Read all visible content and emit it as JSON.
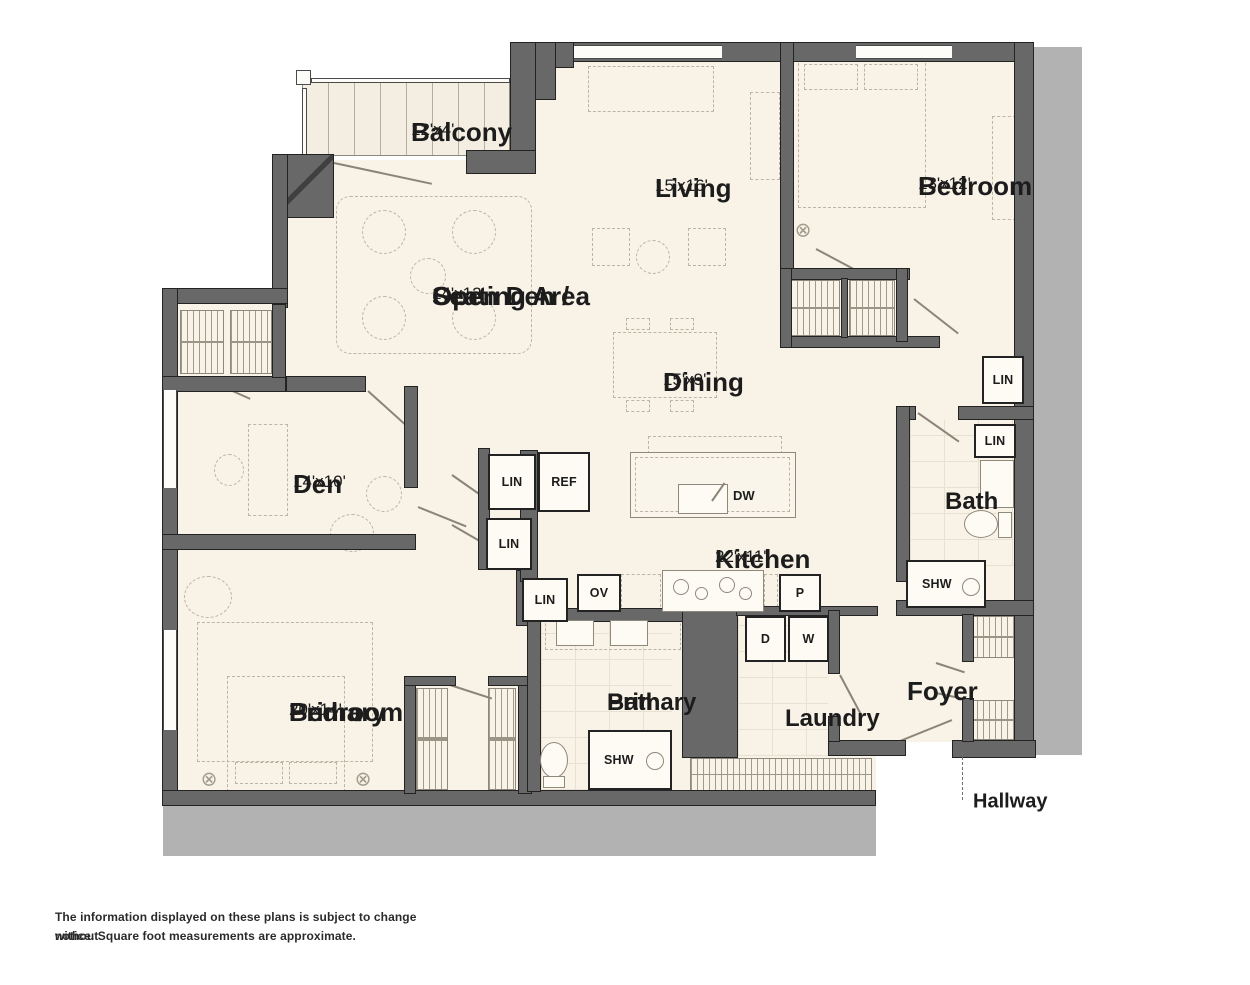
{
  "rooms": {
    "balcony": {
      "name": "Balcony",
      "dims": "12'x4'"
    },
    "living": {
      "name": "Living",
      "dims": "15'x16'"
    },
    "bedroom": {
      "name": "Bedroom",
      "dims": "13'x12'"
    },
    "open_den": {
      "name_line1": "Open Den /",
      "name_line2": "Seating Area",
      "dims": "14'x12'"
    },
    "dining": {
      "name": "Dining",
      "dims": "15'x9'"
    },
    "den": {
      "name": "Den",
      "dims": "14'x10'"
    },
    "kitchen": {
      "name": "Kitchen",
      "dims": "22'x11'"
    },
    "bath": {
      "name": "Bath"
    },
    "primary_bedroom": {
      "name_line1": "Primary",
      "name_line2": "Bedroom",
      "dims": "20'x14'"
    },
    "primary_bath": {
      "name_line1": "Primary",
      "name_line2": "Bath"
    },
    "laundry": {
      "name": "Laundry"
    },
    "foyer": {
      "name": "Foyer"
    },
    "hallway": {
      "name": "Hallway"
    }
  },
  "fixtures": {
    "lin_hall": "LIN",
    "lin_bath": "LIN",
    "lin_kitchen_top": "LIN",
    "lin_kitchen_mid": "LIN",
    "lin_kitchen_bottom": "LIN",
    "ref": "REF",
    "dw": "DW",
    "ov": "OV",
    "pantry": "P",
    "dryer": "D",
    "washer": "W",
    "shw_bath": "SHW",
    "shw_primary_bath": "SHW"
  },
  "disclaimer": {
    "line1": "The information displayed on these plans is subject to change without",
    "line2": "notice. Square foot measurements are approximate."
  },
  "colors": {
    "wall": "#686868",
    "floor": "#f8f2e7",
    "shadow": "#b2b2b2",
    "text": "#1c1c1c"
  }
}
